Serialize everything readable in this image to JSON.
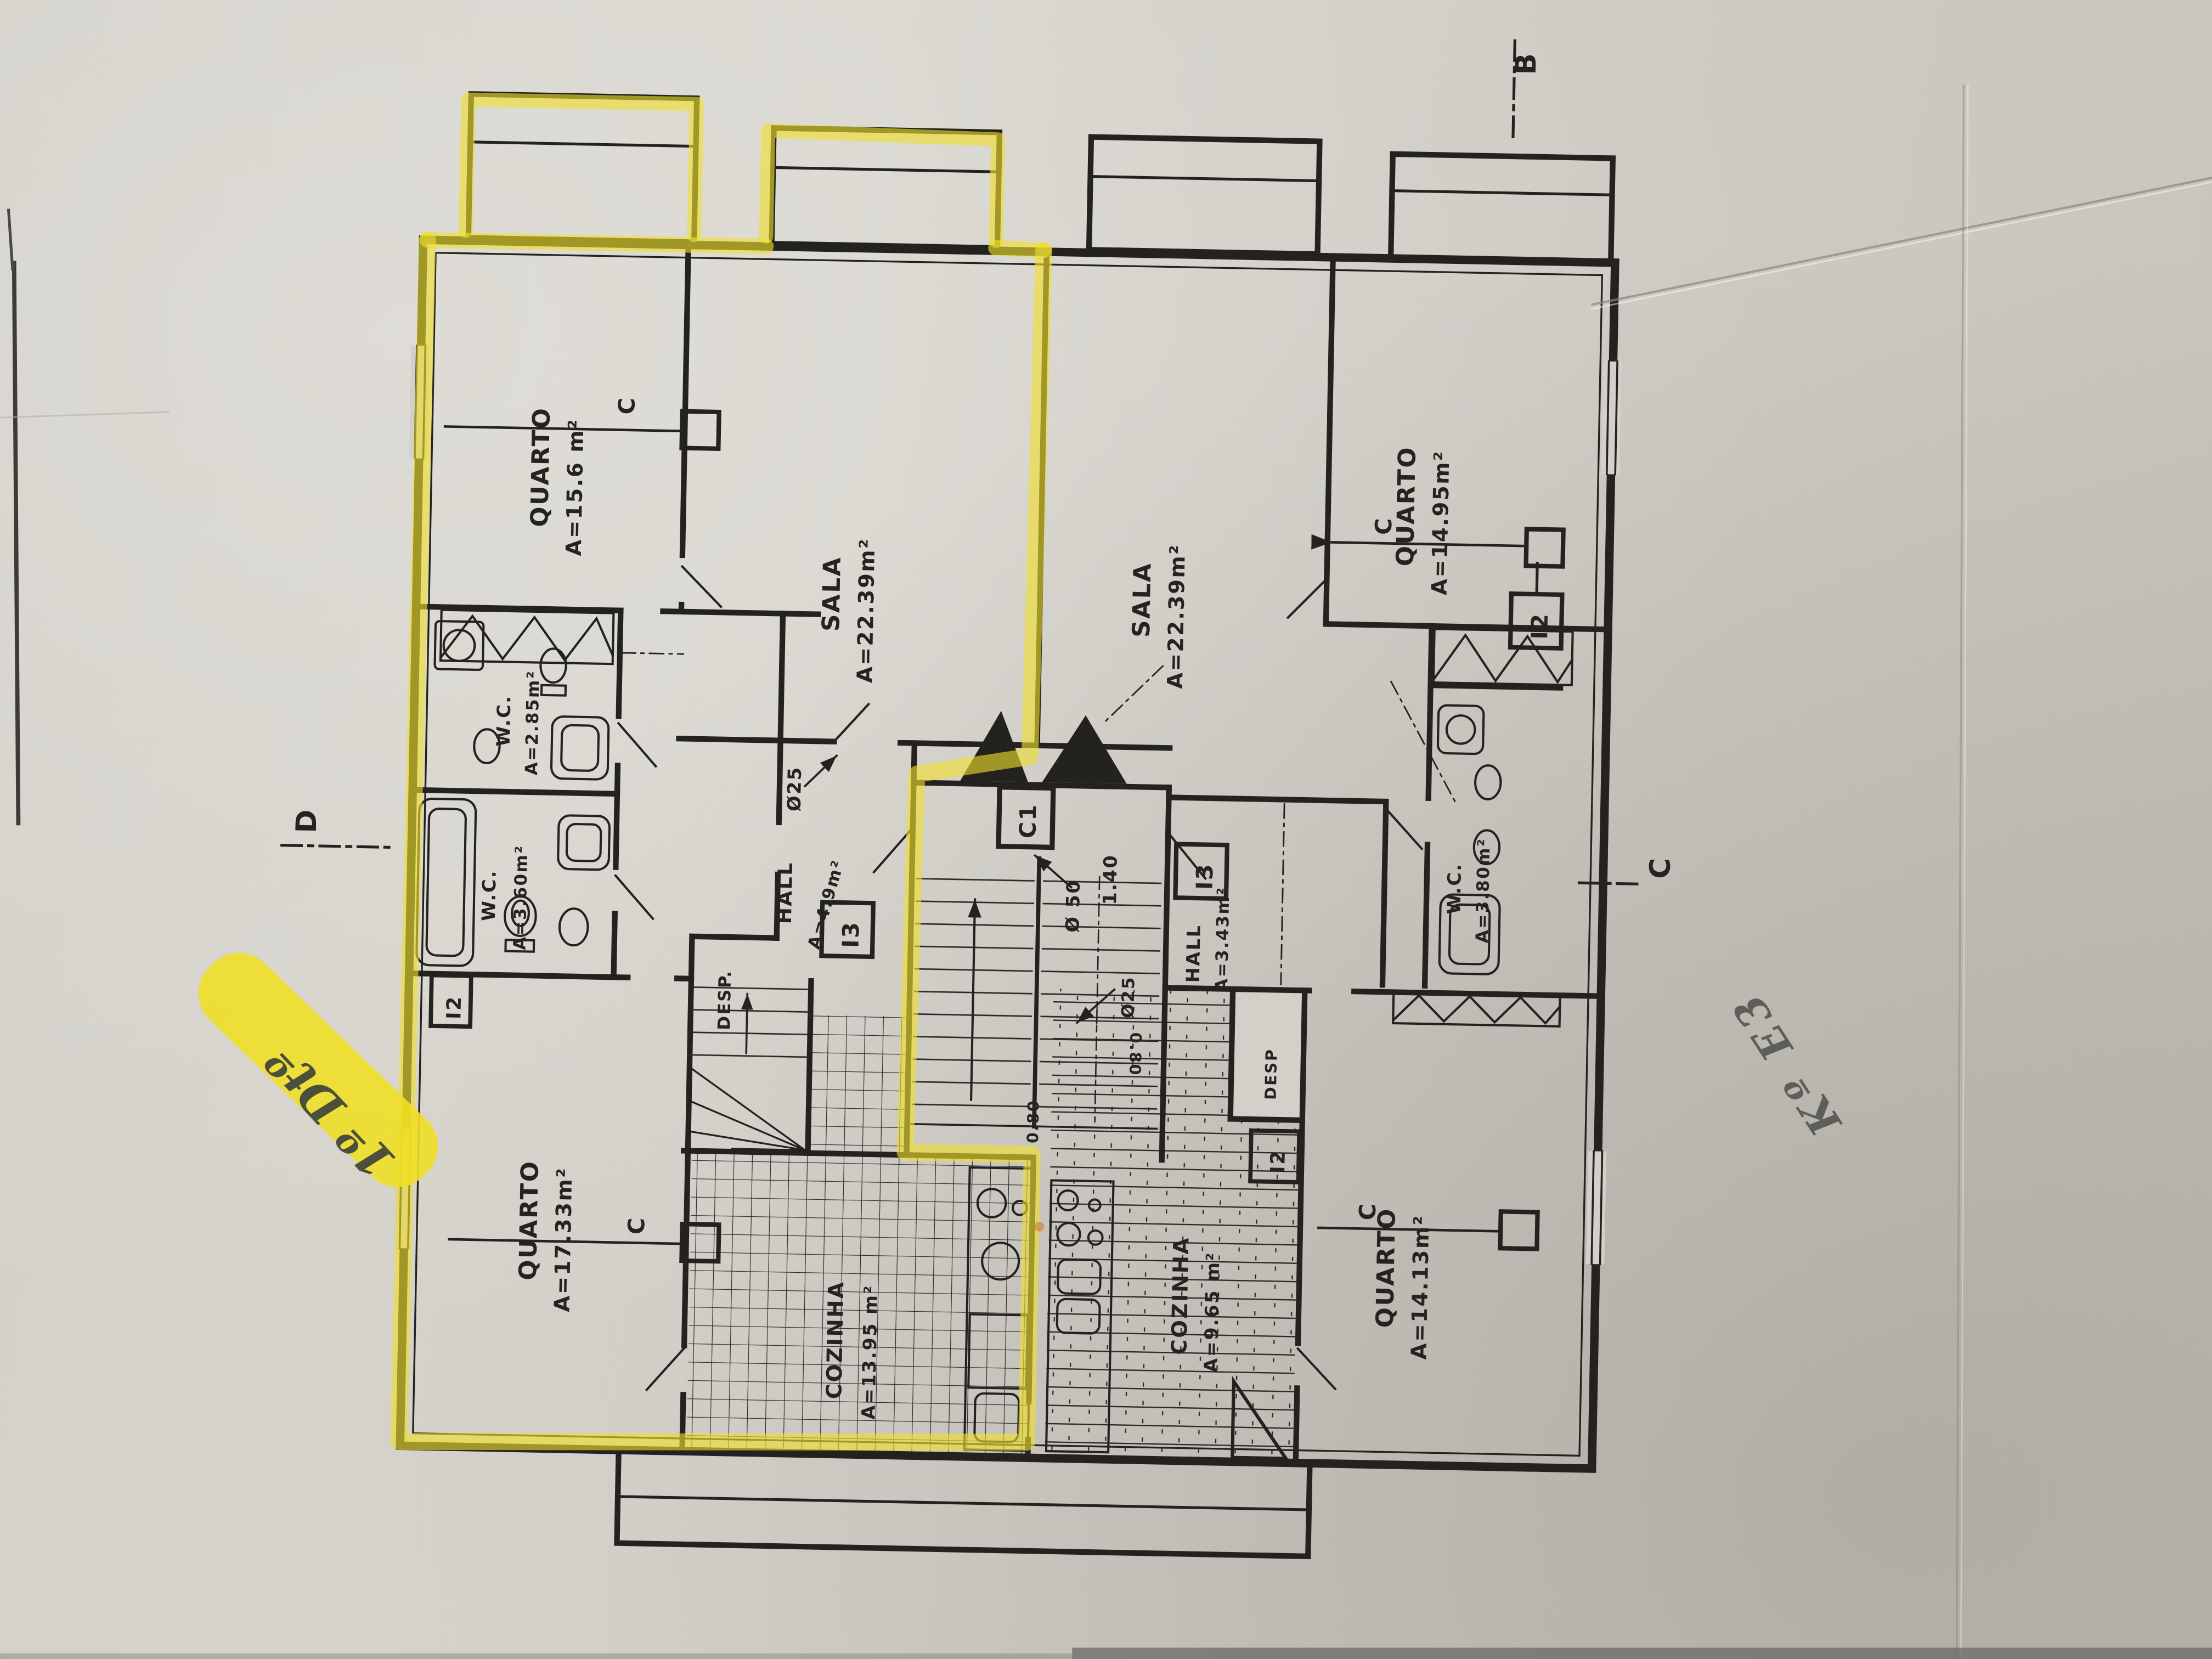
{
  "meta": {
    "description": "Photograph of a scanned architectural storey floor plan, rotated 90°, left apartment boundary traced with yellow highlighter, handwritten notes on paper"
  },
  "colors": {
    "paper": "#d3d0c9",
    "ink": "#23221e",
    "highlight": "#efdf2d",
    "pencil": "#5e5e58"
  },
  "apartment_left": {
    "quarto_top": {
      "name": "QUARTO",
      "area": "A=15.6 m²"
    },
    "sala": {
      "name": "SALA",
      "area": "A=22.39m²"
    },
    "wc_small": {
      "name": "W.C.",
      "area": "A=2.85m²"
    },
    "wc_large": {
      "name": "W.C.",
      "area": "A=3.60m²"
    },
    "hall": {
      "name": "HALL",
      "dia": "Ø25",
      "area": "A=4.9m²"
    },
    "desp": {
      "name": "DESP."
    },
    "quarto_bottom": {
      "name": "QUARTO",
      "area": "A=17.33m²"
    },
    "cozinha": {
      "name": "COZINHA",
      "area": "A=13.95 m²"
    }
  },
  "apartment_right": {
    "sala": {
      "name": "SALA",
      "area": "A=22.39m²"
    },
    "quarto_top": {
      "name": "QUARTO",
      "area": "A=14.95m²"
    },
    "wc": {
      "name": "W.C.",
      "area": "A=3.80m²"
    },
    "hall": {
      "name": "HALL",
      "area": "A=3.43m²"
    },
    "desp": {
      "name": "DESP"
    },
    "cozinha": {
      "name": "COZINHA",
      "area": "A=9.65 m²"
    },
    "quarto_bottom": {
      "name": "QUARTO",
      "area": "A=14.13m²"
    }
  },
  "core": {
    "elevator": "C1",
    "stair_labels": {
      "d50": "Ø 50",
      "w140": "1.40",
      "d25": "Ø25",
      "r080a": "0.80",
      "r080b": "0.80"
    }
  },
  "door_boxes": {
    "i3_left": "I3",
    "i3_right": "I3",
    "i2_wc": "I2",
    "i2_right_top": "I2",
    "i2_right_bottom": "I2"
  },
  "section_markers": {
    "b": "B",
    "c": "C",
    "d": "D",
    "c_line_q1": "C",
    "c_line_q2": "C",
    "c_line_q3": "C",
    "c_line_q4": "C"
  },
  "annotations": {
    "unit_left": "1º Dtº",
    "note_right": "Kº E3"
  }
}
